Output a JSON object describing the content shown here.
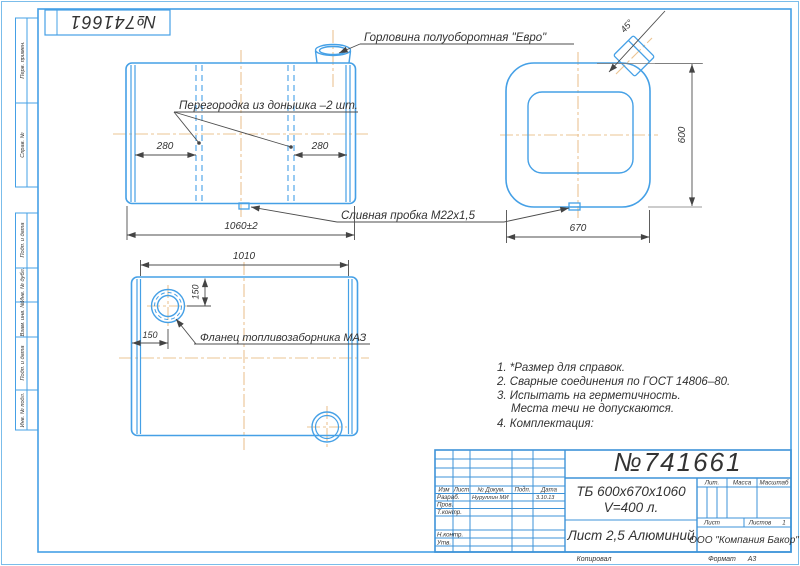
{
  "meta": {
    "stamp_number": "№741661"
  },
  "margin_labels": {
    "l0": "Перв. примен.",
    "l1": "Справ. №",
    "l2": "Подп. и дата",
    "l3": "Инв. № дубл.",
    "l4": "Взам. инв. №",
    "l5": "Подп. и дата",
    "l6": "Инв. № подл."
  },
  "annotations": {
    "neck": "Горловина полуоборотная \"Евро\"",
    "baffle": "Перегородка из донышка –2 шт.",
    "drain": "Сливная пробка М22х1,5",
    "flange": "Фланец топливозаборника МАЗ"
  },
  "dimensions": {
    "front_width": "1060±2",
    "baffle_left": "280",
    "baffle_right": "280",
    "side_height": "600",
    "side_width": "670",
    "neck_angle": "45°",
    "bottom_length": "1010",
    "flange_top": "150",
    "flange_side": "150"
  },
  "notes": {
    "n1": "1. *Размер для справок.",
    "n2": "2. Сварные соединения по ГОСТ 14806–80.",
    "n3": "3. Испытать на герметичность.",
    "n3b": "Места течи не допускаются.",
    "n4": "4. Комплектация:"
  },
  "title_block": {
    "number": "№741661",
    "name_line1": "ТБ 600х670х1060",
    "name_line2": "V=400 л.",
    "material": "Лист 2,5 Алюминий",
    "company": "ООО \"Компания Бакор\"",
    "rev_headers": {
      "izm": "Изм",
      "list": "Лист",
      "dokum": "№ Докум.",
      "podp": "Подп.",
      "data": "Дата"
    },
    "rows": {
      "razrab": "Разраб.",
      "prov": "Пров.",
      "tkontr": "Т.контр.",
      "nkontr": "Н.контр.",
      "utv": "Утв."
    },
    "designer_name": "Нуруллин МИ",
    "designer_date": "3.10.13",
    "lit_label": "Лит.",
    "mass_label": "Масса",
    "scale_label": "Масштаб",
    "sheet_label": "Лист",
    "sheets_label": "Листов",
    "sheets_value": "1",
    "copied_label": "Копировал",
    "format_label": "Формат",
    "format_value": "А3"
  },
  "colors": {
    "line_blue": "#45a0e6",
    "center_orange": "#ebc493",
    "ink": "#4d4d4d"
  }
}
